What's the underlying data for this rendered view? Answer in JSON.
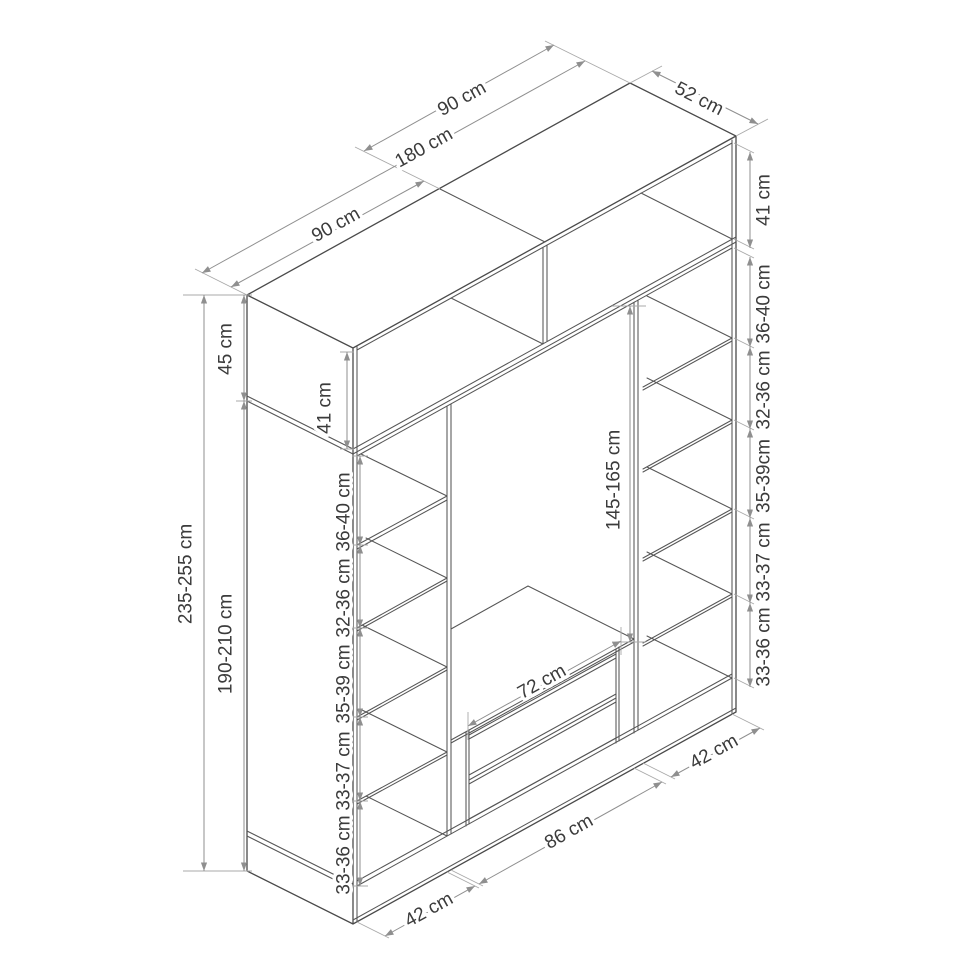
{
  "diagram": {
    "type": "furniture-dimension-drawing",
    "subject": "wardrobe with top cabinet, side shelf columns, hanging section and two drawers",
    "background_color": "#ffffff",
    "line_color": "#4a4a4a",
    "dimension_line_color": "#8f8f8f",
    "text_color": "#3b3b3b",
    "unit": "cm",
    "labels": {
      "top_width_left_half": "90 cm",
      "top_width_total": "180 cm",
      "top_width_right_half": "90 cm",
      "depth": "52 cm",
      "top_cabinet_height": "45 cm",
      "main_cabinet_height": "190-210 cm",
      "total_height": "235-255 cm",
      "top_cabinet_inner_left": "41 cm",
      "top_cabinet_inner_right": "41 cm",
      "left_gap_1": "36-40 cm",
      "left_gap_2": "32-36 cm",
      "left_gap_3": "35-39 cm",
      "left_gap_4": "33-37 cm",
      "left_gap_5": "33-36 cm",
      "right_gap_1": "36-40 cm",
      "right_gap_2": "32-36 cm",
      "right_gap_3": "35-39cm",
      "right_gap_4": "33-37 cm",
      "right_gap_5": "33-36 cm",
      "hanging_space_height": "145-165 cm",
      "hanging_space_width": "72 cm",
      "bottom_left_section": "42 cm",
      "bottom_middle_section": "86 cm",
      "bottom_right_section": "42 cm"
    }
  }
}
